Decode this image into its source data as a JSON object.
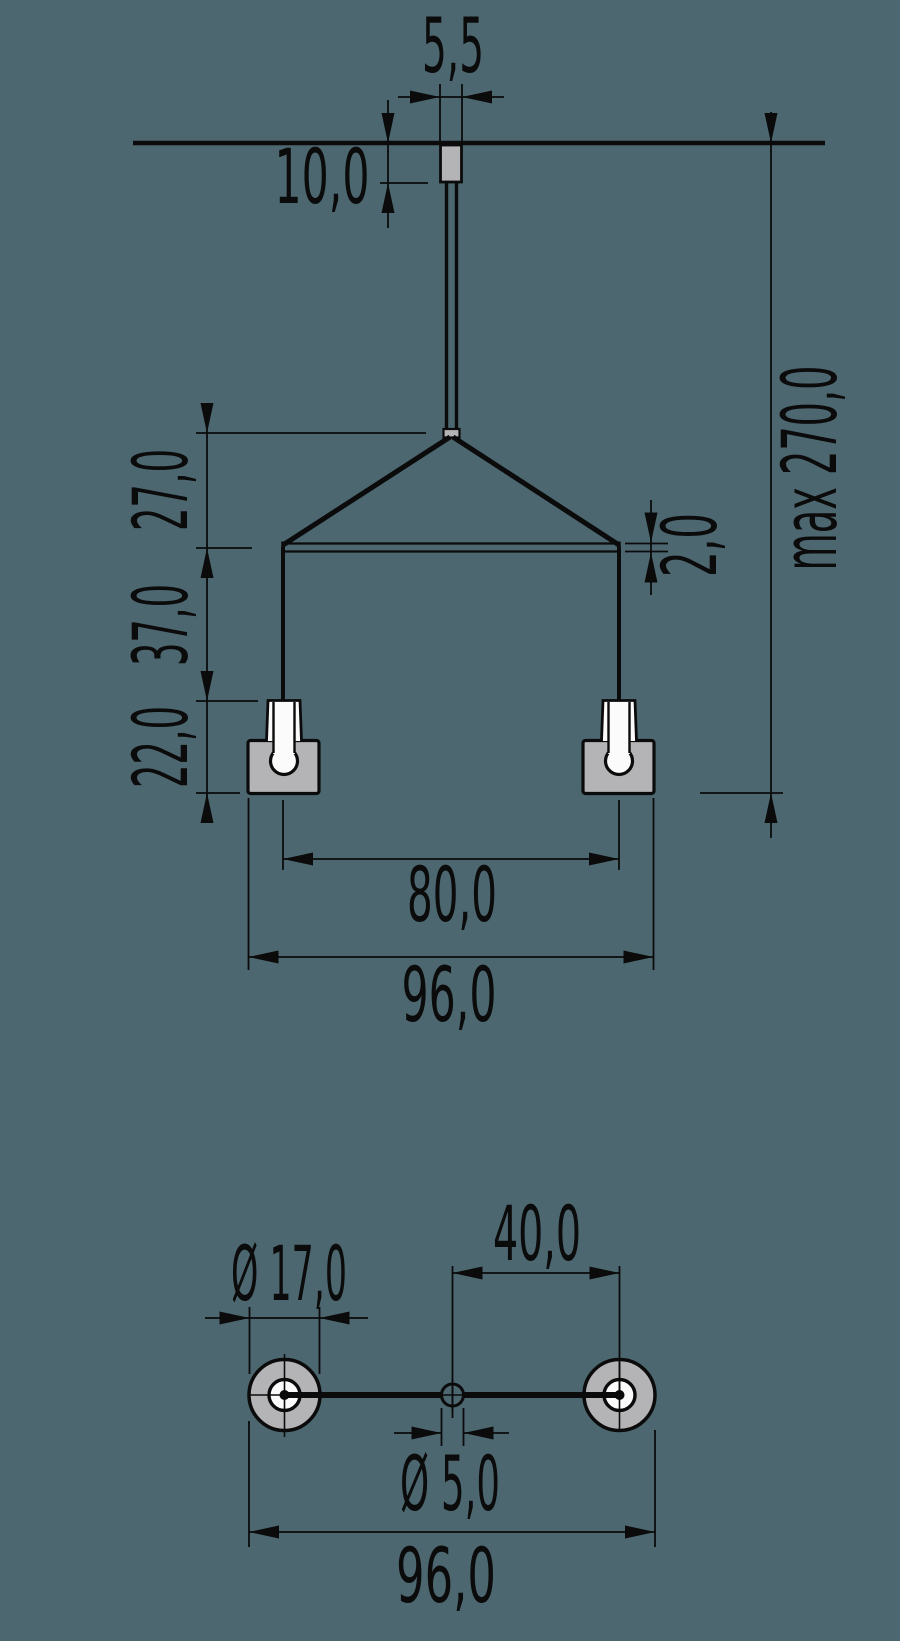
{
  "colors": {
    "background": "#4d6770",
    "line": "#0b0b0b",
    "metal_gray": "#b4b4b7",
    "white": "#fbfbfb"
  },
  "front_view": {
    "stem_width": "5,5",
    "stem_height": "10,0",
    "drop_to_bar": "27,0",
    "bar_to_socket": "37,0",
    "socket_height": "22,0",
    "bar_thickness": "2,0",
    "max_length": "max 270,0",
    "socket_spacing": "80,0",
    "overall_width": "96,0"
  },
  "plan_view": {
    "washer_diameter": "Ø 17,0",
    "center_to_washer": "40,0",
    "center_hole_diameter": "Ø 5,0",
    "overall_width": "96,0"
  }
}
